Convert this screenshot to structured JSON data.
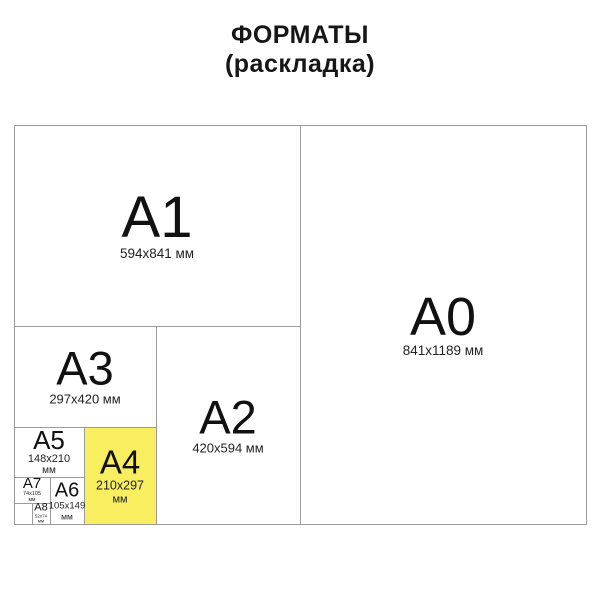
{
  "title": {
    "line1": "ФОРМАТЫ",
    "line2": "(раскладка)"
  },
  "colors": {
    "highlight_fill": "#f8ee5f",
    "border_line": "#9c9c9c"
  },
  "formats": {
    "a0": {
      "label": "A0",
      "size": "841x1189 мм",
      "unit": ""
    },
    "a1": {
      "label": "A1",
      "size": "594x841 мм",
      "unit": ""
    },
    "a2": {
      "label": "A2",
      "size": "420x594 мм",
      "unit": ""
    },
    "a3": {
      "label": "A3",
      "size": "297x420 мм",
      "unit": ""
    },
    "a4": {
      "label": "A4",
      "size": "210x297",
      "unit": "мм"
    },
    "a5": {
      "label": "A5",
      "size": "148x210",
      "unit": "мм"
    },
    "a6": {
      "label": "A6",
      "size": "105x149",
      "unit": "мм"
    },
    "a7": {
      "label": "A7",
      "size": "74x105",
      "unit": "мм"
    },
    "a8": {
      "label": "A8",
      "size": "52x74",
      "unit": "мм"
    }
  }
}
